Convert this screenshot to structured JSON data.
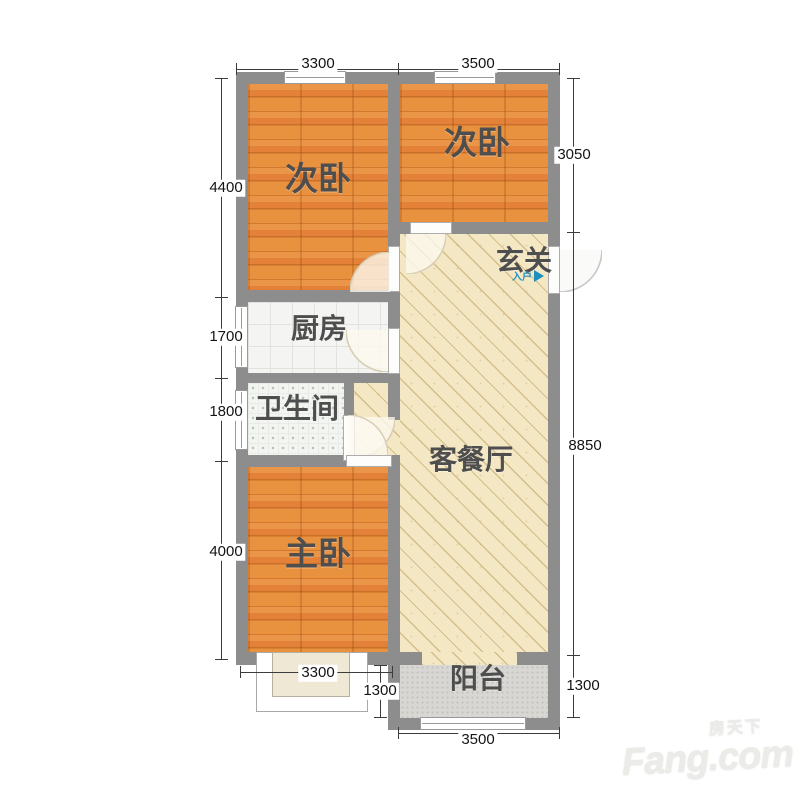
{
  "rooms": {
    "bedroom_left": "次卧",
    "bedroom_right": "次卧",
    "entry": "玄关",
    "kitchen": "厨房",
    "bathroom": "卫生间",
    "living": "客餐厅",
    "master": "主卧",
    "balcony": "阳台",
    "entry_arrow": "入户"
  },
  "dimensions": {
    "top_left_width": "3300",
    "top_right_width": "3500",
    "left_bedroom_height": "4400",
    "kitchen_height": "1700",
    "bath_height": "1800",
    "master_height": "4000",
    "right_bedroom_height": "3050",
    "living_height": "8850",
    "balcony_right_depth": "1300",
    "master_bottom_width": "3300",
    "balcony_left_depth": "1300",
    "balcony_bottom_width": "3500"
  },
  "watermark": {
    "cn": "房天下",
    "en": "Fang.com"
  },
  "colors": {
    "wall": "#8d8d8d",
    "wood": "#e0873c",
    "living_floor": "#f4e7c4",
    "balcony_floor": "#d8d7d3",
    "entry_arrow": "#1f8fc0"
  }
}
